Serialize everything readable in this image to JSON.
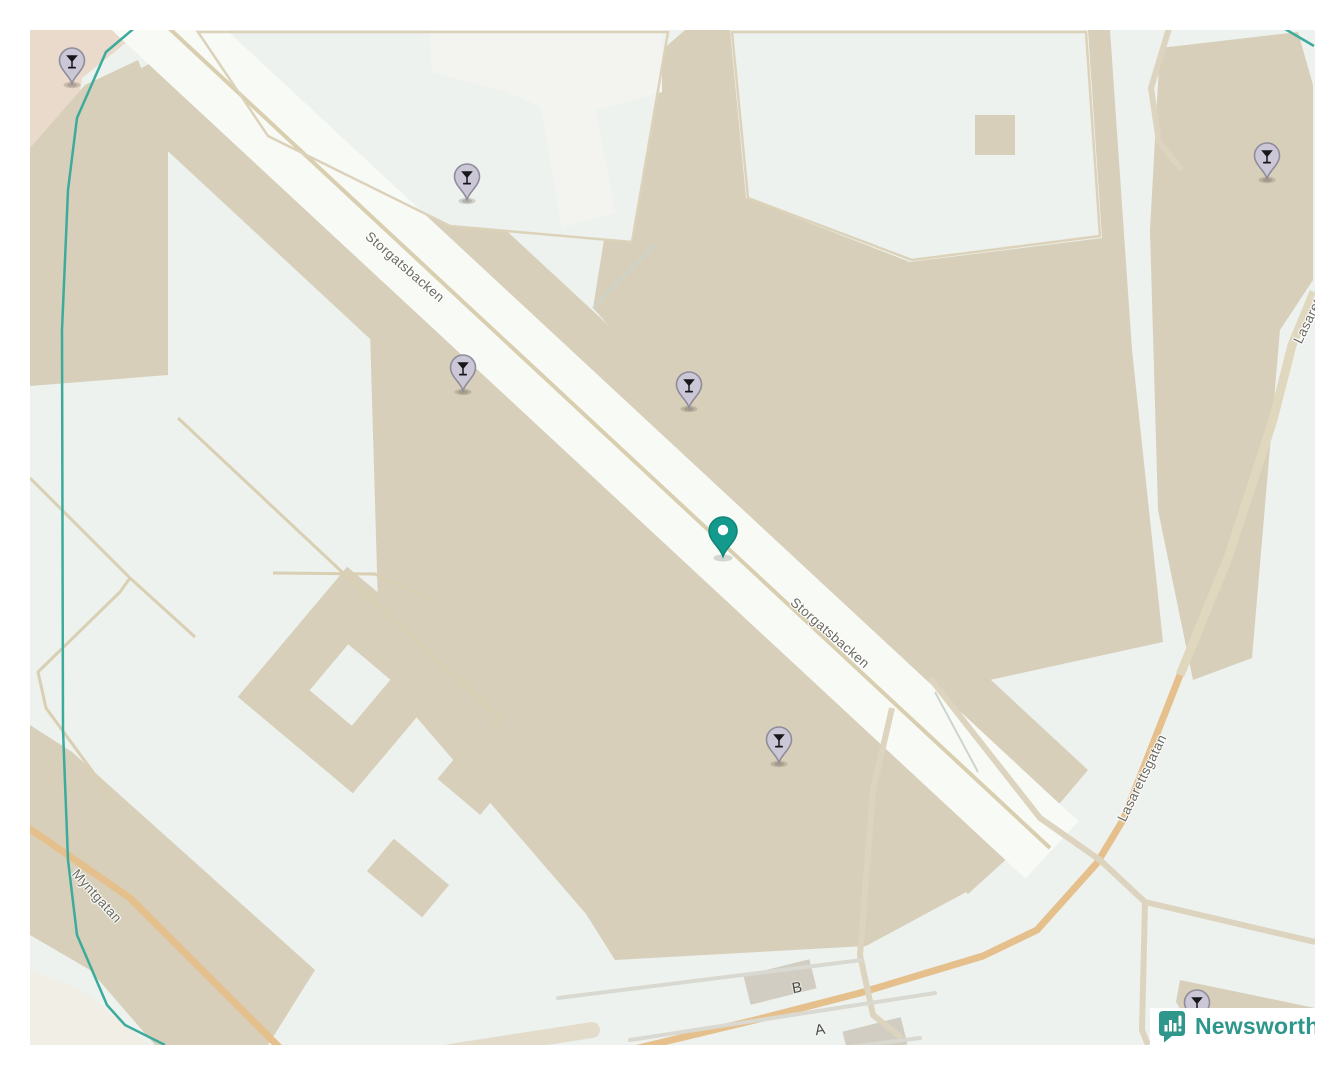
{
  "map": {
    "street_labels": [
      {
        "text": "Storgatsbacken",
        "x": 375,
        "y": 237,
        "rot": 41
      },
      {
        "text": "Storgatsbacken",
        "x": 800,
        "y": 603,
        "rot": 41
      },
      {
        "text": "Myntgatan",
        "x": 67,
        "y": 866,
        "rot": 48
      },
      {
        "text": "Lasarettsgatan",
        "x": 1112,
        "y": 748,
        "rot": -64
      },
      {
        "text": "Lasarettsgatan",
        "x": 1288,
        "y": 270,
        "rot": -64
      }
    ],
    "stop_labels": [
      {
        "text": "B",
        "x": 767,
        "y": 958,
        "rot": -10
      },
      {
        "text": "A",
        "x": 790,
        "y": 1000,
        "rot": -10
      }
    ],
    "markers": {
      "poi_icon": "cocktail-glass",
      "poi": [
        {
          "x": 42,
          "y": 30
        },
        {
          "x": 437,
          "y": 146
        },
        {
          "x": 433,
          "y": 337
        },
        {
          "x": 659,
          "y": 354
        },
        {
          "x": 749,
          "y": 709
        },
        {
          "x": 1237,
          "y": 125
        },
        {
          "x": 1167,
          "y": 972
        }
      ],
      "highlight": {
        "x": 693,
        "y": 500
      }
    },
    "palette": {
      "open": "#edf2ee",
      "block": "#d7cfb9",
      "street": "#f8faf6",
      "road_main": "#e5c08d",
      "road_minor": "#ddd4bf",
      "boundary": "#3cab9b",
      "marker_poi": "#cbc7d7",
      "marker_poi_border": "#8f8c9c",
      "marker_highlight": "#149a8c"
    }
  },
  "branding": {
    "logo_text": "Newsworthy",
    "color": "#2f968c",
    "icon": "bar-chart-speech-bubble"
  }
}
